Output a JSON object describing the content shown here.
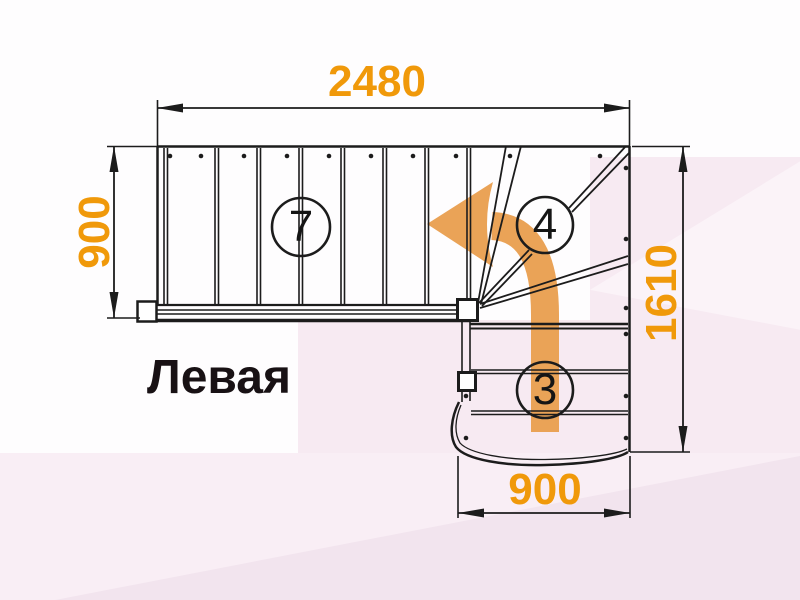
{
  "drawing": {
    "title_label": "Левая",
    "dimensions": {
      "top_width": "2480",
      "left_height": "900",
      "right_height": "1610",
      "bottom_width": "900"
    },
    "step_counts": {
      "upper_flight": "7",
      "winder": "4",
      "lower_flight": "3"
    },
    "icons": {
      "direction_arrow": "curved-left-direction-arrow"
    },
    "colors": {
      "dimension_text": "#F0990A",
      "direction_arrow": "#EAA357",
      "drawing_line": "#1C1C1C",
      "label_text": "#181114",
      "background_tint": "#F7EAF2"
    }
  }
}
